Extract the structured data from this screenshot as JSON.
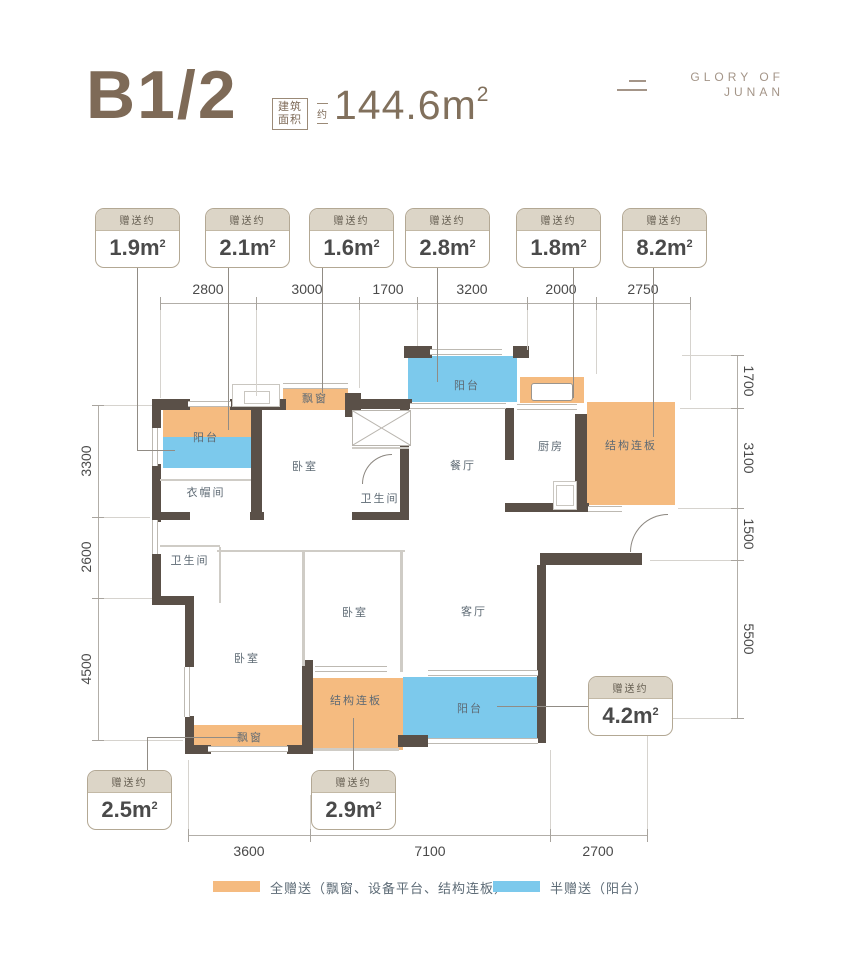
{
  "header": {
    "plan_name": "B1/2",
    "area_box_line1": "建筑",
    "area_box_line2": "面积",
    "approx": "约",
    "area_value": "144.6",
    "area_unit": "m",
    "area_sup": "2",
    "logo_line1": "GLORY OF",
    "logo_line2": "JUNAN"
  },
  "callouts": {
    "label": "赠送约",
    "unit": "m",
    "sup": "2",
    "items": [
      {
        "value": "1.9"
      },
      {
        "value": "2.1"
      },
      {
        "value": "1.6"
      },
      {
        "value": "2.8"
      },
      {
        "value": "1.8"
      },
      {
        "value": "8.2"
      },
      {
        "value": "4.2"
      },
      {
        "value": "2.5"
      },
      {
        "value": "2.9"
      }
    ]
  },
  "rooms": [
    {
      "name": "阳台"
    },
    {
      "name": "飘窗"
    },
    {
      "name": "卧室"
    },
    {
      "name": "衣帽间"
    },
    {
      "name": "卫生间"
    },
    {
      "name": "阳台"
    },
    {
      "name": "餐厅"
    },
    {
      "name": "厨房"
    },
    {
      "name": "结构连板"
    },
    {
      "name": "卫生间"
    },
    {
      "name": "卧室"
    },
    {
      "name": "卧室"
    },
    {
      "name": "客厅"
    },
    {
      "name": "结构连板"
    },
    {
      "name": "阳台"
    },
    {
      "name": "飘窗"
    }
  ],
  "dimensions": {
    "top": [
      "2800",
      "3000",
      "1700",
      "3200",
      "2000",
      "2750"
    ],
    "bottom": [
      "3600",
      "7100",
      "2700"
    ],
    "left": [
      "3300",
      "2600",
      "4500"
    ],
    "right": [
      "1700",
      "3100",
      "1500",
      "5500"
    ]
  },
  "legend": {
    "items": [
      {
        "label": "全赠送（飘窗、设备平台、结构连板）",
        "color": "#f5bb80"
      },
      {
        "label": "半赠送（阳台）",
        "color": "#7cc9ec"
      }
    ]
  },
  "colors": {
    "orange": "#f5bb80",
    "blue": "#7cc9ec",
    "wall": "#5a5048",
    "brown": "#7e6a57"
  }
}
